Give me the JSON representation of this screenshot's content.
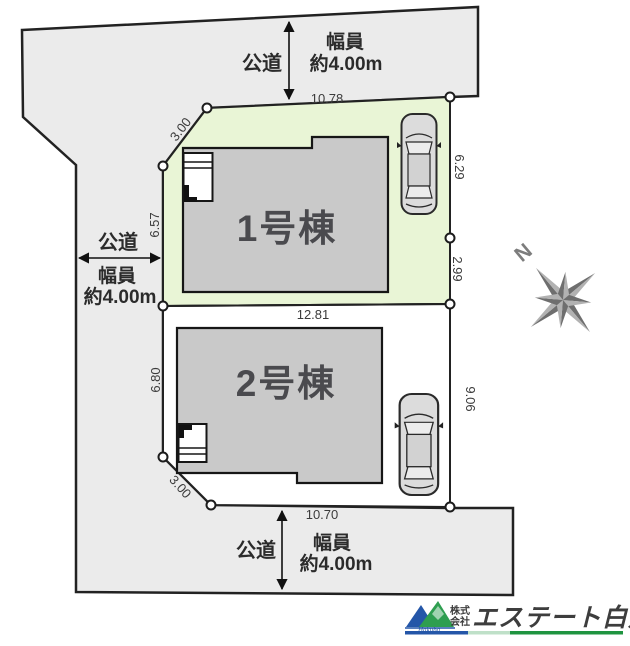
{
  "site_plan": {
    "roads": {
      "top": {
        "name": "公道",
        "width_line1": "幅員",
        "width_line2": "約4.00m"
      },
      "left": {
        "name": "公道",
        "width_line1": "幅員",
        "width_line2": "約4.00m"
      },
      "bottom": {
        "name": "公道",
        "width_line1": "幅員",
        "width_line2": "約4.00m"
      }
    },
    "lots": [
      {
        "label": "1号棟",
        "dims": {
          "top": "10.78",
          "upper_diagonal": "3.00",
          "left": "6.57",
          "right_upper": "6.29",
          "right_lower": "2.99",
          "bottom": "12.81"
        }
      },
      {
        "label": "2号棟",
        "dims": {
          "left": "6.80",
          "right": "9.06",
          "lower_diagonal": "3.00",
          "bottom": "10.70"
        }
      }
    ],
    "compass": {
      "north_label": "N"
    },
    "colors": {
      "road_fill": "#ebebeb",
      "lot1_fill": "#e9f5d6",
      "lot2_fill": "#ffffff",
      "house_fill": "#c9c9c9",
      "outline": "#222222",
      "dim_text": "#3b3b3b",
      "compass_dark": "#6e6e6e",
      "compass_light": "#b2b2b2"
    }
  },
  "logo": {
    "prefix_line1": "株式",
    "prefix_line2": "会社",
    "company": "エステート白馬",
    "script": "Hakuba",
    "accent_blue": "#2456a8",
    "accent_green": "#1f9440",
    "accent_pale_green": "#bfe0c8"
  }
}
